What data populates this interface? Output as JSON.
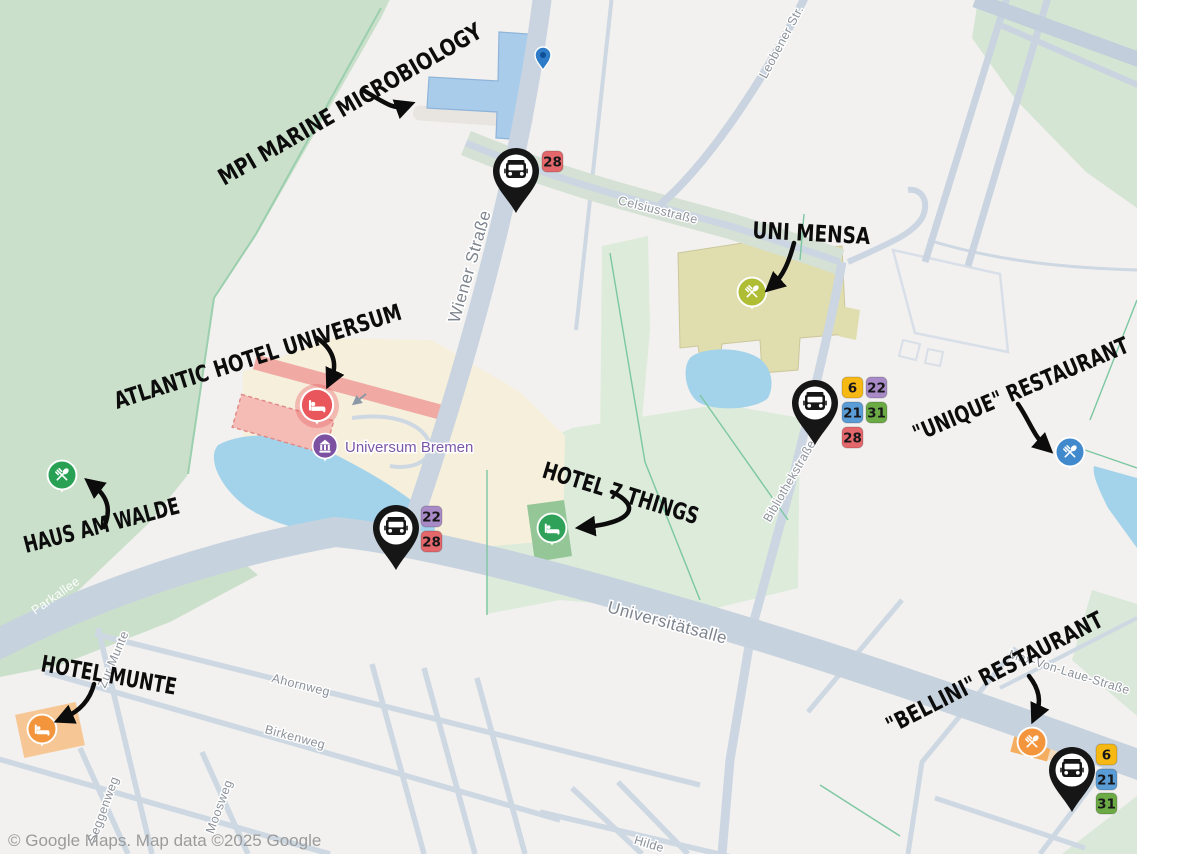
{
  "attribution": "© Google Maps. Map data ©2025 Google",
  "streets": {
    "wiener": "Wiener Straße",
    "celsius": "Celsiusstraße",
    "leobener": "Leobener Str.",
    "bibliothek": "Bibliothekstraße",
    "universitaet": "Universitätsalle",
    "parkallee": "Parkallee",
    "zur_munte": "Zur Munte",
    "ahornweg": "Ahornweg",
    "birkenweg": "Birkenweg",
    "seggenweg": "Seggenweg",
    "moosweg": "Moosweg",
    "hilden": "Hilde",
    "max_von_laue": "Max-Von-Laue-Straße"
  },
  "pois": {
    "universum": "Universum Bremen"
  },
  "annotations": {
    "mpi": "MPI MARINE MICROBIOLOGY",
    "mensa": "UNI MENSA",
    "atlantic": "ATLANTIC HOTEL UNIVERSUM",
    "haus_am_walde": "HAUS AM WALDE",
    "seven_things": "HOTEL 7 THINGS",
    "munte": "HOTEL MUNTE",
    "unique": "\"UNIQUE\" RESTAURANT",
    "bellini": "\"BELLINI\" RESTAURANT"
  },
  "bus_routes": {
    "r6": "6",
    "r21": "21",
    "r22": "22",
    "r28": "28",
    "r31": "31"
  },
  "colors": {
    "route6": "#F6B914",
    "route21": "#5A9CD6",
    "route22": "#A88BC6",
    "route28": "#E4686B",
    "route31": "#6BAA45",
    "restaurant_green": "#28A155",
    "restaurant_blue": "#4089CC",
    "restaurant_orange": "#F2953D",
    "mensa_olive": "#AEBD33",
    "hotel_red": "#E9565B",
    "hotel_green": "#2FA159",
    "hotel_orange": "#F2953D",
    "museum_purple": "#7C51A1"
  }
}
